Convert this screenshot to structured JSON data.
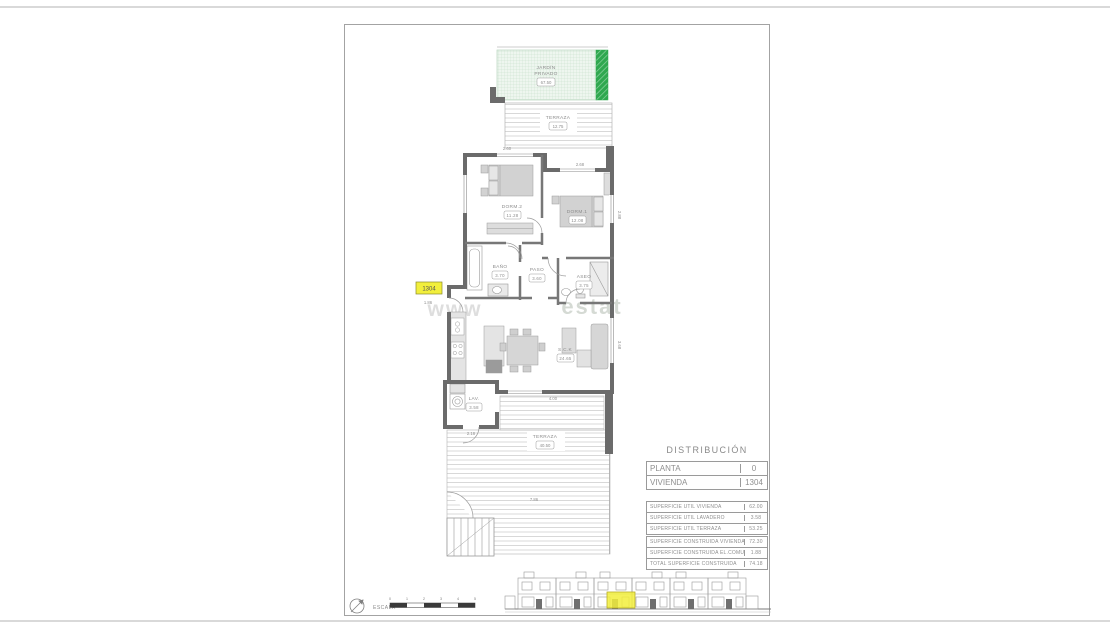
{
  "colors": {
    "highlight_yellow": "#f2ef3c",
    "garden_green": "#2fa84f",
    "wall_gray": "#6b6b6b"
  },
  "plan": {
    "watermark_left": "www",
    "watermark_right": "estat",
    "unit_badge": "1304",
    "garden": {
      "l1": "JARDÍN",
      "l2": "PRIVADO",
      "area": "67.50"
    },
    "terrace_top": {
      "label": "TERRAZA",
      "area": "12.75"
    },
    "dorm2": {
      "label": "DORM.2",
      "area": "11.28"
    },
    "dorm1": {
      "label": "DORM.1",
      "area": "12.08"
    },
    "bano": {
      "label": "BAÑO",
      "area": "3.70"
    },
    "paso": {
      "label": "PASO",
      "area": "3.60"
    },
    "aseo": {
      "label": "ASEO",
      "area": "3.75"
    },
    "sck": {
      "label": "S.C.K",
      "area": "24.65"
    },
    "lav": {
      "label": "LAV.",
      "area": "3.58"
    },
    "terrace_bottom": {
      "label": "TERRAZA",
      "area": "40.50"
    },
    "dims": {
      "dorm2_top": "2.60",
      "dorm1_top": "2.68",
      "entry": "1.86",
      "living_bottom": "4.00",
      "lav_bottom": "2.16",
      "terrace_width": "7.86",
      "dorm1_right": "2.88",
      "living_right": "3.68"
    }
  },
  "distribution": {
    "title": "DISTRIBUCIÓN",
    "info_rows": [
      {
        "label": "PLANTA",
        "value": "0"
      },
      {
        "label": "VIVIENDA",
        "value": "1304"
      }
    ],
    "util_rows": [
      {
        "label": "SUPERFICIE ÚTIL VIVIENDA",
        "value": "62.00"
      },
      {
        "label": "SUPERFICIE ÚTIL LAVADERO",
        "value": "3.58"
      },
      {
        "label": "SUPERFICIE ÚTIL TERRAZA",
        "value": "53.25"
      }
    ],
    "built_rows": [
      {
        "label": "SUPERFICIE CONSTRUIDA VIVIENDA",
        "value": "72.30"
      },
      {
        "label": "SUPERFICIE CONSTRUIDA EL.COMUNES",
        "value": "1.88"
      },
      {
        "label": "TOTAL SUPERFICIE CONSTRUIDA",
        "value": "74.18"
      }
    ]
  },
  "footer": {
    "escala": "ESCALA",
    "ticks": [
      "0",
      "1",
      "2",
      "3",
      "4",
      "5"
    ]
  }
}
